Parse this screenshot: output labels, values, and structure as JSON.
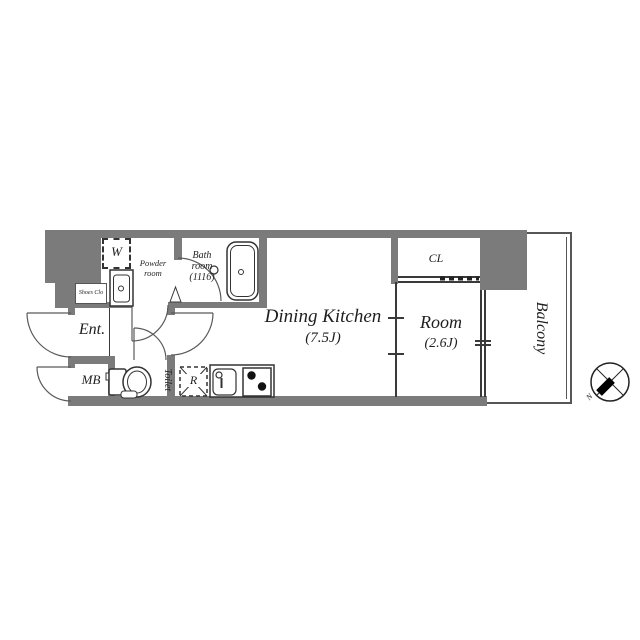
{
  "title": "apartment-floor-plan",
  "colors": {
    "wall": "#7b7b7b",
    "line": "#3a3a3a",
    "text": "#1f1f1f"
  },
  "rooms": {
    "dining_kitchen": {
      "name": "Dining Kitchen",
      "size": "(7.5J)"
    },
    "room": {
      "name": "Room",
      "size": "(2.6J)"
    },
    "balcony": {
      "label": "Balcony"
    },
    "closet": {
      "label": "CL"
    },
    "bath": {
      "line1": "Bath",
      "line2": "room",
      "line3": "(1116)"
    },
    "powder": {
      "line1": "Powder",
      "line2": "room"
    },
    "entrance": {
      "label": "Ent."
    },
    "shoes_closet": {
      "label": "Shoes Clo"
    },
    "meter_box": {
      "label": "MB"
    },
    "toilet": {
      "label": "Toilet"
    },
    "washer": {
      "label": "W"
    },
    "refrigerator": {
      "label": "R"
    }
  },
  "compass": {
    "north": "N"
  }
}
